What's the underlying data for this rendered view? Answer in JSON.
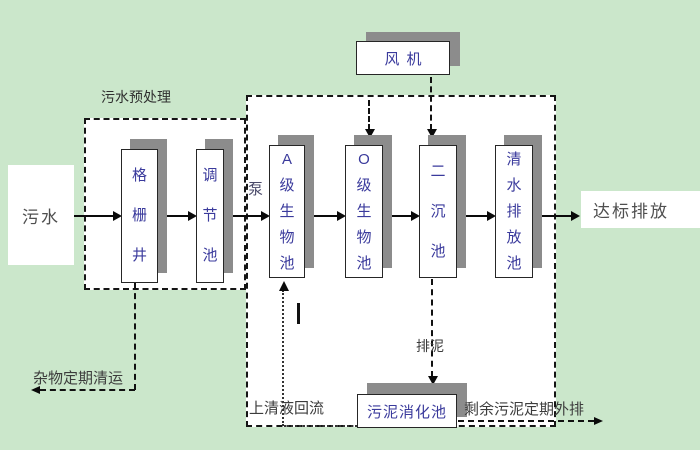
{
  "diagram_title": "wastewater-treatment-process-flow",
  "colors": {
    "background": "#cbe7cb",
    "region_fill": "#ffffff",
    "box_shadow": "#8c8c8c",
    "node_text": "#3a3a9c",
    "label_text": "#3c3c3c",
    "line": "#111111"
  },
  "nodes": {
    "influent": "污水",
    "grid_well": "格栅井",
    "regulating_tank": "调节池",
    "blower": "风机",
    "a_bio_tank": "A级生物池",
    "o_bio_tank": "O级生物池",
    "secondary_clarifier": "二沉池",
    "clear_water_tank": "清水排放池",
    "effluent": "达标排放",
    "sludge_digestion_tank": "污泥消化池"
  },
  "labels": {
    "pretreatment": "污水预处理",
    "pump": "泵",
    "debris_removal": "杂物定期清运",
    "supernatant_return": "上清液回流",
    "sludge_discharge": "排泥",
    "excess_sludge": "剩余污泥定期外排"
  }
}
